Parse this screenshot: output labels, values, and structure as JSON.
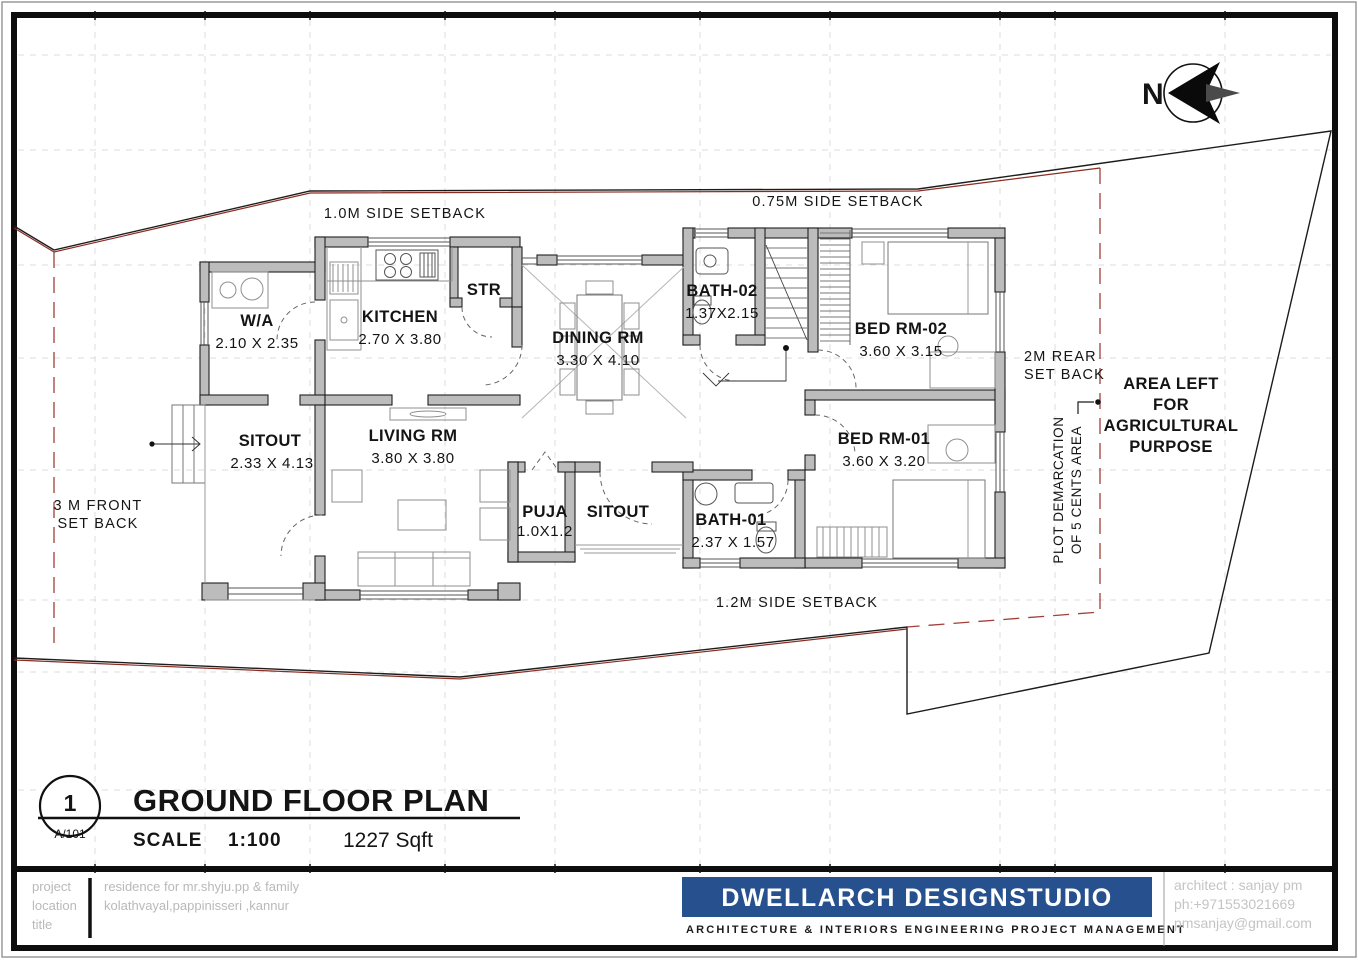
{
  "north": {
    "letter": "N"
  },
  "labels": {
    "setback_top_left": "1.0M  SIDE  SETBACK",
    "setback_top_right": "0.75M   SIDE  SETBACK",
    "setback_rear": [
      "2M  REAR",
      "SET  BACK"
    ],
    "setback_front": [
      "3  M  FRONT",
      "SET  BACK"
    ],
    "setback_bottom": "1.2M  SIDE  SETBACK",
    "area_note": [
      "AREA LEFT",
      "FOR",
      "AGRICULTURAL",
      "PURPOSE"
    ],
    "plot_demarcation": [
      "PLOT  DEMARCATION",
      "OF  5  CENTS  AREA"
    ]
  },
  "rooms": {
    "wa": {
      "name": "W/A",
      "dims": "2.10  X  2.35"
    },
    "kitchen": {
      "name": "KITCHEN",
      "dims": "2.70  X  3.80"
    },
    "str": {
      "name": "STR"
    },
    "dining": {
      "name": "DINING RM",
      "dims": "3.30  X  4.10"
    },
    "bath2": {
      "name": "BATH-02",
      "dims": "1.37X2.15"
    },
    "bed2": {
      "name": "BED RM-02",
      "dims": "3.60  X  3.15"
    },
    "bed1": {
      "name": "BED RM-01",
      "dims": "3.60  X  3.20"
    },
    "sitout_front": {
      "name": "SITOUT",
      "dims": "2.33  X  4.13"
    },
    "living": {
      "name": "LIVING RM",
      "dims": "3.80  X  3.80"
    },
    "puja": {
      "name": "PUJA",
      "dims": "1.0X1.2"
    },
    "sitout_rear": {
      "name": "SITOUT"
    },
    "bath1": {
      "name": "BATH-01",
      "dims": "2.37  X  1.57"
    }
  },
  "title_block": {
    "drawing_number": "1",
    "sheet": "A/101",
    "title": "GROUND FLOOR PLAN",
    "scale_label": "SCALE",
    "scale_value": "1:100",
    "area": "1227 Sqft"
  },
  "footer": {
    "side_labels": [
      "project",
      "location",
      "title"
    ],
    "project": "residence for mr.shyju.pp & family",
    "location": "kolathvayal,pappinisseri ,kannur",
    "company": "DWELLARCH DESIGNSTUDIO",
    "tagline": "ARCHITECTURE   &  INTERIORS    ENGINEERING  PROJECT  MANAGEMENT",
    "architect": "architect : sanjay pm",
    "phone": "ph:+971553021669",
    "email": "pmsanjay@gmail.com"
  },
  "colors": {
    "boundary_red": "#8b2b21",
    "wall_fill": "#bcbcbc",
    "wall_edge": "#1f1f1f",
    "brand_blue": "#26508e",
    "grid": "#dcdcdc",
    "muted_text": "#b9b9b9"
  }
}
